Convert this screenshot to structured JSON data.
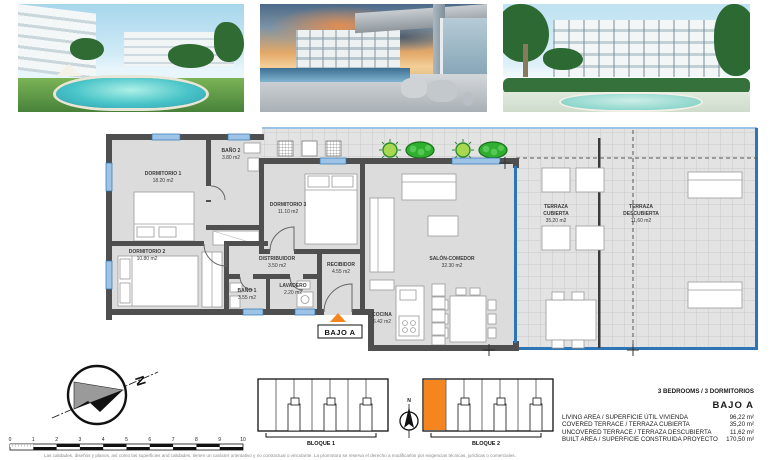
{
  "plan": {
    "entrance_label": "BAJO A",
    "rooms": [
      {
        "name": "DORMITORIO 1",
        "area": "18.20 m2"
      },
      {
        "name": "BAÑO 2",
        "area": "3.80 m2"
      },
      {
        "name": "DORMITORIO 3",
        "area": "11.10 m2"
      },
      {
        "name": "DORMITORIO 2",
        "area": "10.80 m2"
      },
      {
        "name": "DISTRIBUIDOR",
        "area": "3.50 m2"
      },
      {
        "name": "RECIBIDOR",
        "area": "4.55 m2"
      },
      {
        "name": "BAÑO 1",
        "area": "3.55 m2"
      },
      {
        "name": "LAVADERO",
        "area": "2.20 m2"
      },
      {
        "name": "SALÓN-COMEDOR",
        "area": "32.30 m2"
      },
      {
        "name": "COCINA",
        "area": "6.42 m2"
      },
      {
        "name": "TERRAZA",
        "name2": "CUBIERTA",
        "area": "35.20 m2"
      },
      {
        "name": "TERRAZA",
        "name2": "DESCUBIERTA",
        "area": "11,60 m2"
      }
    ]
  },
  "compass": {
    "north_label": "N"
  },
  "mini_compass": {
    "north_label": "N"
  },
  "scale_bar": {
    "ticks": [
      "0",
      "1",
      "2",
      "3",
      "4",
      "5",
      "6",
      "7",
      "8",
      "9",
      "10"
    ]
  },
  "blocks": [
    {
      "label": "BLOQUE 1"
    },
    {
      "label": "BLOQUE 2"
    }
  ],
  "summary": {
    "bedrooms_line": "3 BEDROOMS / 3 DORMITORIOS",
    "unit_label": "BAJO A",
    "rows": [
      {
        "label": "LIVING AREA / SUPERFICIE ÚTIL VIVIENDA",
        "value": "96,22 m²"
      },
      {
        "label": "COVERED TERRACE / TERRAZA CUBIERTA",
        "value": "35,20 m²"
      },
      {
        "label": "UNCOVERED TERRACE / TERRAZA DESCUBIERTA",
        "value": "11,62 m²"
      },
      {
        "label": "BUILT AREA / SUPERFICIE CONSTRUIDA PROYECTO",
        "value": "170,50 m²"
      }
    ]
  },
  "disclaimer": "Las calidades, diseños y planos, así como las superficies and calidades, tienen un carácter orientativo y no contractual o vinculante. La promotora se reserva el derecho a modificarlos por exigencias técnicas, jurídicas o comerciales.",
  "colors": {
    "accent_orange": "#F5861F",
    "window_blue": "#2E75B6",
    "bush_green": "#2FAE2F"
  }
}
